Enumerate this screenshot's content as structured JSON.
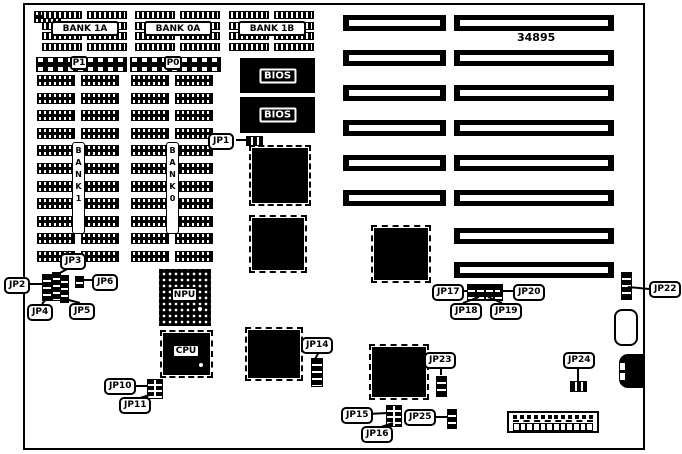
{
  "diagram": {
    "part_number": "34895",
    "memory": {
      "top_banks": [
        "BANK 1A",
        "BANK 0A",
        "BANK 1B"
      ],
      "arrays": [
        {
          "port": "P1",
          "bank": "BANK1"
        },
        {
          "port": "P0",
          "bank": "BANK0"
        }
      ]
    },
    "chips": {
      "bios1": "BIOS",
      "bios2": "BIOS",
      "npu": "NPU",
      "cpu": "CPU"
    },
    "jumper_labels": [
      {
        "text": "JP1",
        "x": 208,
        "y": 133
      },
      {
        "text": "JP2",
        "x": 4,
        "y": 277
      },
      {
        "text": "JP3",
        "x": 60,
        "y": 253
      },
      {
        "text": "JP4",
        "x": 27,
        "y": 304
      },
      {
        "text": "JP5",
        "x": 69,
        "y": 303
      },
      {
        "text": "JP6",
        "x": 92,
        "y": 274
      },
      {
        "text": "JP10",
        "x": 104,
        "y": 378
      },
      {
        "text": "JP11",
        "x": 119,
        "y": 397
      },
      {
        "text": "JP14",
        "x": 301,
        "y": 337
      },
      {
        "text": "JP15",
        "x": 341,
        "y": 407
      },
      {
        "text": "JP16",
        "x": 361,
        "y": 426
      },
      {
        "text": "JP17",
        "x": 432,
        "y": 284
      },
      {
        "text": "JP18",
        "x": 450,
        "y": 303
      },
      {
        "text": "JP19",
        "x": 490,
        "y": 303
      },
      {
        "text": "JP20",
        "x": 513,
        "y": 284
      },
      {
        "text": "JP22",
        "x": 649,
        "y": 281
      },
      {
        "text": "JP23",
        "x": 424,
        "y": 352
      },
      {
        "text": "JP24",
        "x": 563,
        "y": 352
      },
      {
        "text": "JP25",
        "x": 404,
        "y": 409
      }
    ]
  }
}
